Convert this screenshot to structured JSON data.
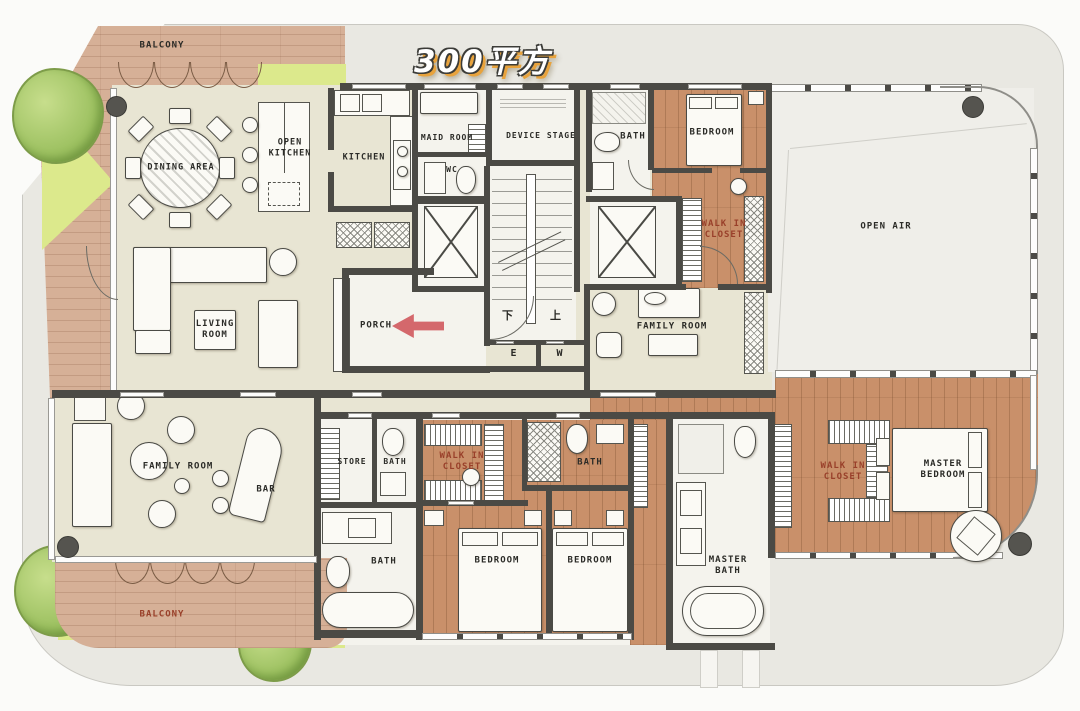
{
  "title": "300平方",
  "palette": {
    "wall": "#4b4a45",
    "wood": "#c9906a",
    "balcony_wood": "#d6b097",
    "floor_cream": "#e8e5d3",
    "outside_gray": "#e9e8e2",
    "grass": "#dce98c",
    "tree": "#9dc161",
    "label_red": "#99402a",
    "entry_arrow": "#d4686c",
    "title_shadow": "#e8a33d"
  },
  "rooms": {
    "balcony_top": "BALCONY",
    "dining": "DINING AREA",
    "open_kitchen": "OPEN KITCHEN",
    "kitchen": "KITCHEN",
    "maid": "MAID ROOM",
    "wc": "WC",
    "device": "DEVICE STAGE",
    "bath_top": "BATH",
    "bedroom_top": "BEDROOM",
    "wic_top": "WALK IN CLOSET",
    "open_air": "OPEN AIR",
    "porch": "PORCH",
    "family_right": "FAMILY ROOM",
    "living": "LIVING ROOM",
    "family_left": "FAMILY ROOM",
    "bar": "BAR",
    "store": "STORE",
    "bath_store": "BATH",
    "wic_mid": "WALK IN CLOSET",
    "bath_mid": "BATH",
    "bath_lower": "BATH",
    "bedroom1": "BEDROOM",
    "bedroom2": "BEDROOM",
    "master_bath": "MASTER BATH",
    "wic_master": "WALK IN CLOSET",
    "master_bedroom": "MASTER BEDROOM",
    "balcony_bottom": "BALCONY"
  },
  "stairs": {
    "down": "下",
    "up": "上"
  },
  "elevator_lobby": {
    "e": "E",
    "w": "W"
  }
}
